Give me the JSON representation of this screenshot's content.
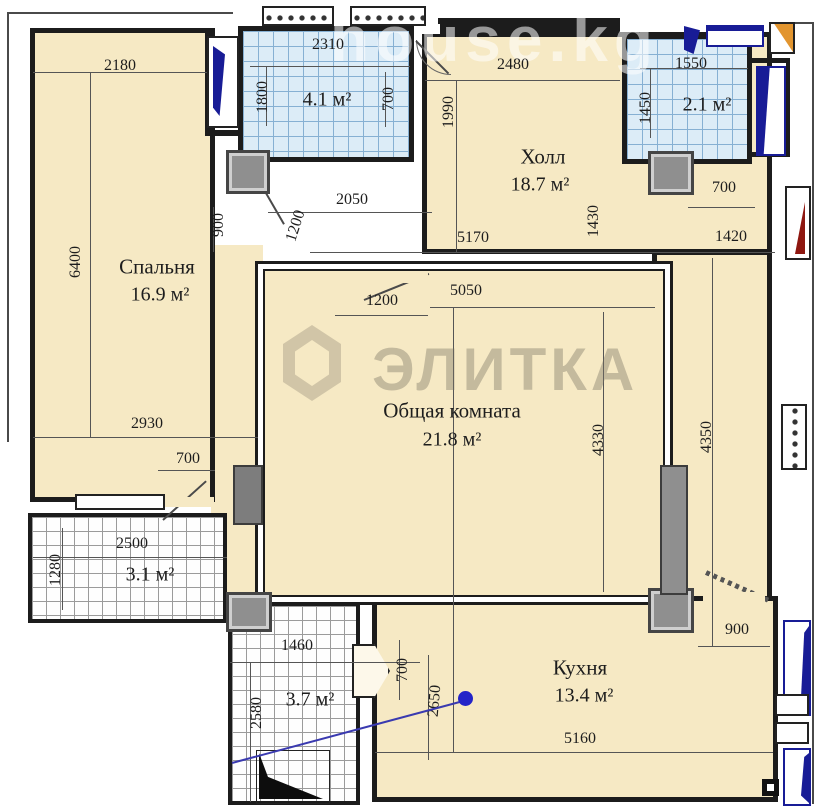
{
  "watermarks": {
    "top": "house.kg",
    "brand": "ЭЛИТКА"
  },
  "rooms": {
    "bedroom": {
      "name": "Спальня",
      "area": "16.9 м²"
    },
    "hall": {
      "name": "Холл",
      "area": "18.7 м²"
    },
    "living": {
      "name": "Общая комната",
      "area": "21.8 м²"
    },
    "kitchen": {
      "name": "Кухня",
      "area": "13.4 м²"
    },
    "bath": {
      "area": "4.1 м²"
    },
    "wc": {
      "area": "2.1 м²"
    },
    "loggia_small": {
      "area": "3.1 м²"
    },
    "loggia_big": {
      "area": "3.7 м²"
    }
  },
  "dims": [
    {
      "t": "2180",
      "x": 120,
      "y": 66,
      "r": 0
    },
    {
      "t": "2310",
      "x": 328,
      "y": 45,
      "r": 0
    },
    {
      "t": "1800",
      "x": 263,
      "y": 97,
      "r": -90
    },
    {
      "t": "700",
      "x": 389,
      "y": 99,
      "r": -90
    },
    {
      "t": "2480",
      "x": 513,
      "y": 65,
      "r": 0
    },
    {
      "t": "1550",
      "x": 691,
      "y": 64,
      "r": 0
    },
    {
      "t": "1450",
      "x": 646,
      "y": 108,
      "r": -90
    },
    {
      "t": "1990",
      "x": 449,
      "y": 112,
      "r": -90
    },
    {
      "t": "900",
      "x": 219,
      "y": 225,
      "r": -90
    },
    {
      "t": "1200",
      "x": 296,
      "y": 226,
      "r": -72
    },
    {
      "t": "2050",
      "x": 352,
      "y": 200,
      "r": 0
    },
    {
      "t": "5170",
      "x": 473,
      "y": 238,
      "r": 0
    },
    {
      "t": "1430",
      "x": 594,
      "y": 221,
      "r": -90
    },
    {
      "t": "1420",
      "x": 731,
      "y": 237,
      "r": 0
    },
    {
      "t": "700",
      "x": 724,
      "y": 188,
      "r": 0
    },
    {
      "t": "1200",
      "x": 382,
      "y": 301,
      "r": 0
    },
    {
      "t": "5050",
      "x": 466,
      "y": 291,
      "r": 0
    },
    {
      "t": "6400",
      "x": 76,
      "y": 262,
      "r": -90
    },
    {
      "t": "2930",
      "x": 147,
      "y": 424,
      "r": 0
    },
    {
      "t": "700",
      "x": 188,
      "y": 459,
      "r": 0
    },
    {
      "t": "4330",
      "x": 599,
      "y": 440,
      "r": -90
    },
    {
      "t": "4350",
      "x": 707,
      "y": 437,
      "r": -90
    },
    {
      "t": "2500",
      "x": 132,
      "y": 544,
      "r": 0
    },
    {
      "t": "1280",
      "x": 56,
      "y": 570,
      "r": -90
    },
    {
      "t": "1460",
      "x": 297,
      "y": 646,
      "r": 0
    },
    {
      "t": "2580",
      "x": 257,
      "y": 713,
      "r": -90
    },
    {
      "t": "700",
      "x": 403,
      "y": 670,
      "r": -90
    },
    {
      "t": "2650",
      "x": 435,
      "y": 701,
      "r": -85
    },
    {
      "t": "900",
      "x": 737,
      "y": 630,
      "r": 0
    },
    {
      "t": "5160",
      "x": 580,
      "y": 739,
      "r": 0
    }
  ]
}
